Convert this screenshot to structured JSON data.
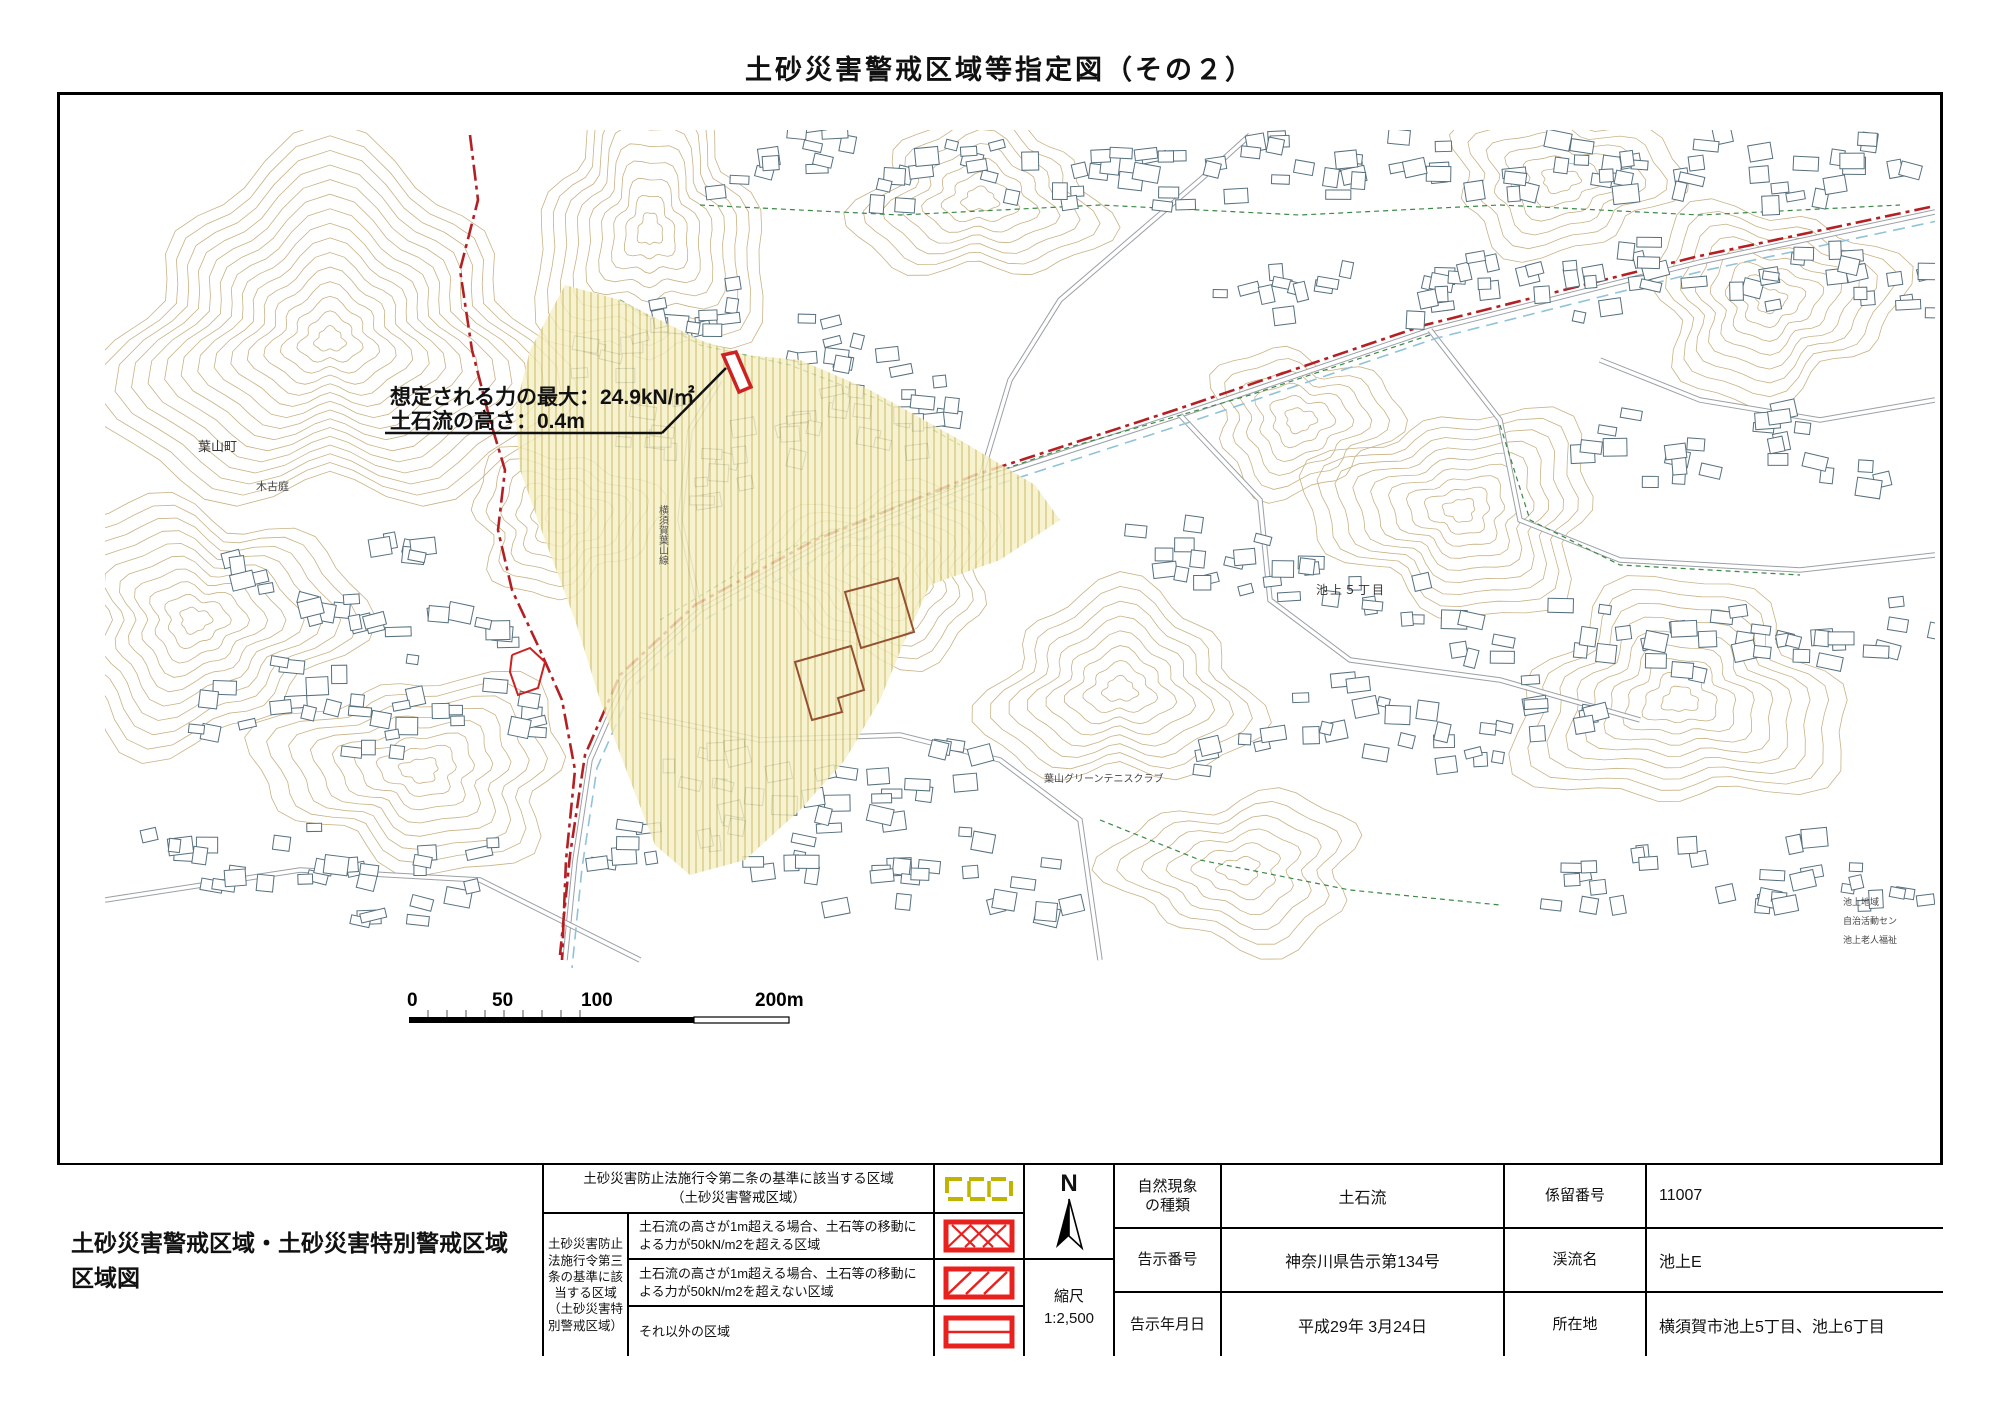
{
  "title": "土砂災害警戒区域等指定図（その２）",
  "sheet_title": "土砂災害警戒区域・土砂災害特別警戒区域\n区域図",
  "annotation": {
    "line1": "想定される力の最大：24.9kN/㎡",
    "line2": "土石流の高さ：0.4m"
  },
  "map_labels": {
    "town": "葉山町",
    "kikoba": "木古庭",
    "ikegami5": "池上５丁目",
    "tennis": "葉山グリーンテニスクラブ",
    "chiiki": "池上地域",
    "jichi": "自治活動セン",
    "rojin": "池上老人福祉",
    "road": "横須賀葉山線"
  },
  "scalebar": {
    "t0": "0",
    "t50": "50",
    "t100": "100",
    "t200": "200m"
  },
  "legend": {
    "title": "土砂災害防止法施行令第二条の基準に該当する区域\n（土砂災害警戒区域）",
    "group_label": "土砂災害防止\n法施行令第三\n条の基準に該\n当する区域\n（土砂災害特\n別警戒区域）",
    "rows": [
      {
        "text": "土石流の高さが1m超える場合、土石等の移動に\nよる力が50kN/m2を超える区域"
      },
      {
        "text": "土石流の高さが1m超える場合、土石等の移動に\nよる力が50kN/m2を超えない区域"
      },
      {
        "text": "それ以外の区域"
      }
    ]
  },
  "compass": {
    "north": "N",
    "scale_label": "縮尺",
    "scale_value": "1:2,500"
  },
  "info": {
    "rows": [
      {
        "label": "自然現象\nの種類",
        "value": "土石流",
        "label2": "係留番号",
        "value2": "11007"
      },
      {
        "label": "告示番号",
        "value": "神奈川県告示第134号",
        "label2": "渓流名",
        "value2": "池上E"
      },
      {
        "label": "告示年月日",
        "value": "平成29年 3月24日",
        "label2": "所在地",
        "value2": "横須賀市池上5丁目、池上6丁目"
      }
    ]
  },
  "colors": {
    "hazard_red": "#e8201e",
    "boundary_red": "#b32024",
    "zone_yellow": "#f5efc6",
    "hatch_yellow": "#d9cd85",
    "legend_olive": "#c0b400",
    "contour_tan": "#c9b284",
    "veg_green": "#3a8a46",
    "stream_blue": "#8fc3d9",
    "building_gray": "#56707e"
  }
}
